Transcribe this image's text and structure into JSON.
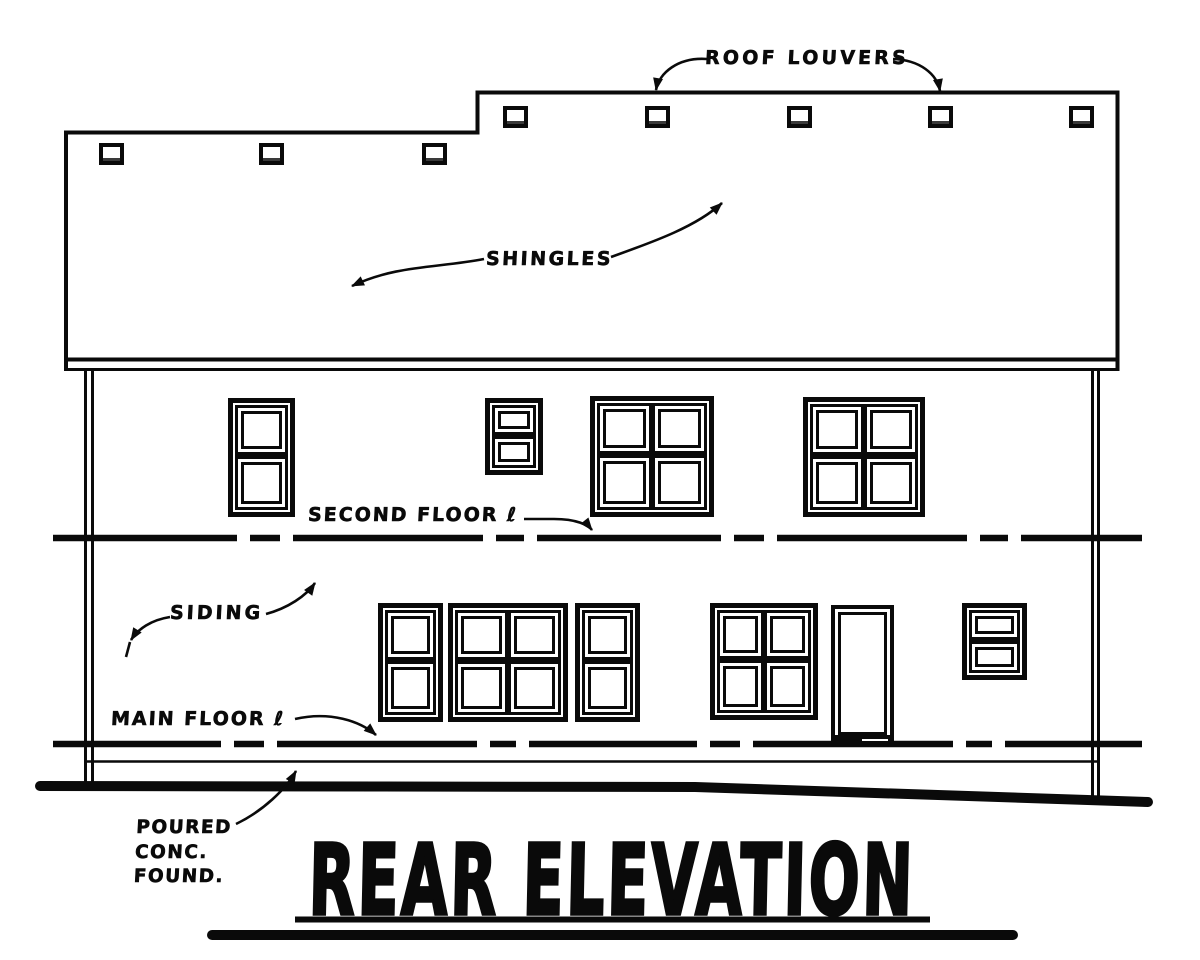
{
  "drawing": {
    "title": "REAR ELEVATION",
    "callouts": {
      "roof_louvers": "ROOF LOUVERS",
      "shingles": "SHINGLES",
      "second_floor": "SECOND FLOOR ℓ",
      "siding": "SIDING",
      "main_floor": "MAIN FLOOR ℓ",
      "foundation_line1": "POURED",
      "foundation_line2": "CONC.",
      "foundation_line3": "FOUND."
    },
    "colors": {
      "ink": "#0a0a0a",
      "paper": "#ffffff",
      "louver_slat": "#3a3a3a"
    }
  }
}
